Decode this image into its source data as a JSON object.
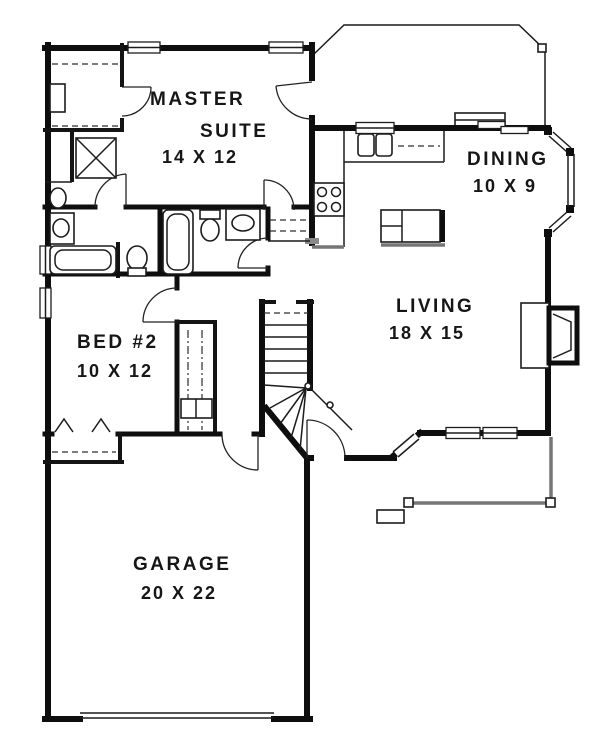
{
  "plan": {
    "title": "single-story house floor plan",
    "rooms": {
      "master": {
        "line1": "MASTER",
        "line2": "SUITE",
        "dims": "14 X 12"
      },
      "dining": {
        "name": "DINING",
        "dims": "10 X 9"
      },
      "living": {
        "name": "LIVING",
        "dims": "18 X 15"
      },
      "bed2": {
        "name": "BED #2",
        "dims": "10 X 12"
      },
      "garage": {
        "name": "GARAGE",
        "dims": "20 X 22"
      }
    },
    "fixtures_depicted": [
      "bathtub",
      "shower",
      "toilet",
      "sink-vanity",
      "kitchen-sink",
      "range-cooktop",
      "island",
      "stairs",
      "fireplace",
      "closet-rod",
      "bifold-doors",
      "garage-door",
      "bay-window",
      "deck",
      "porch"
    ],
    "colors": {
      "wall": "#0e0e0e",
      "thin_line": "#1c1c1c",
      "hatch_gray": "#8a8a8a",
      "background": "#ffffff"
    }
  }
}
